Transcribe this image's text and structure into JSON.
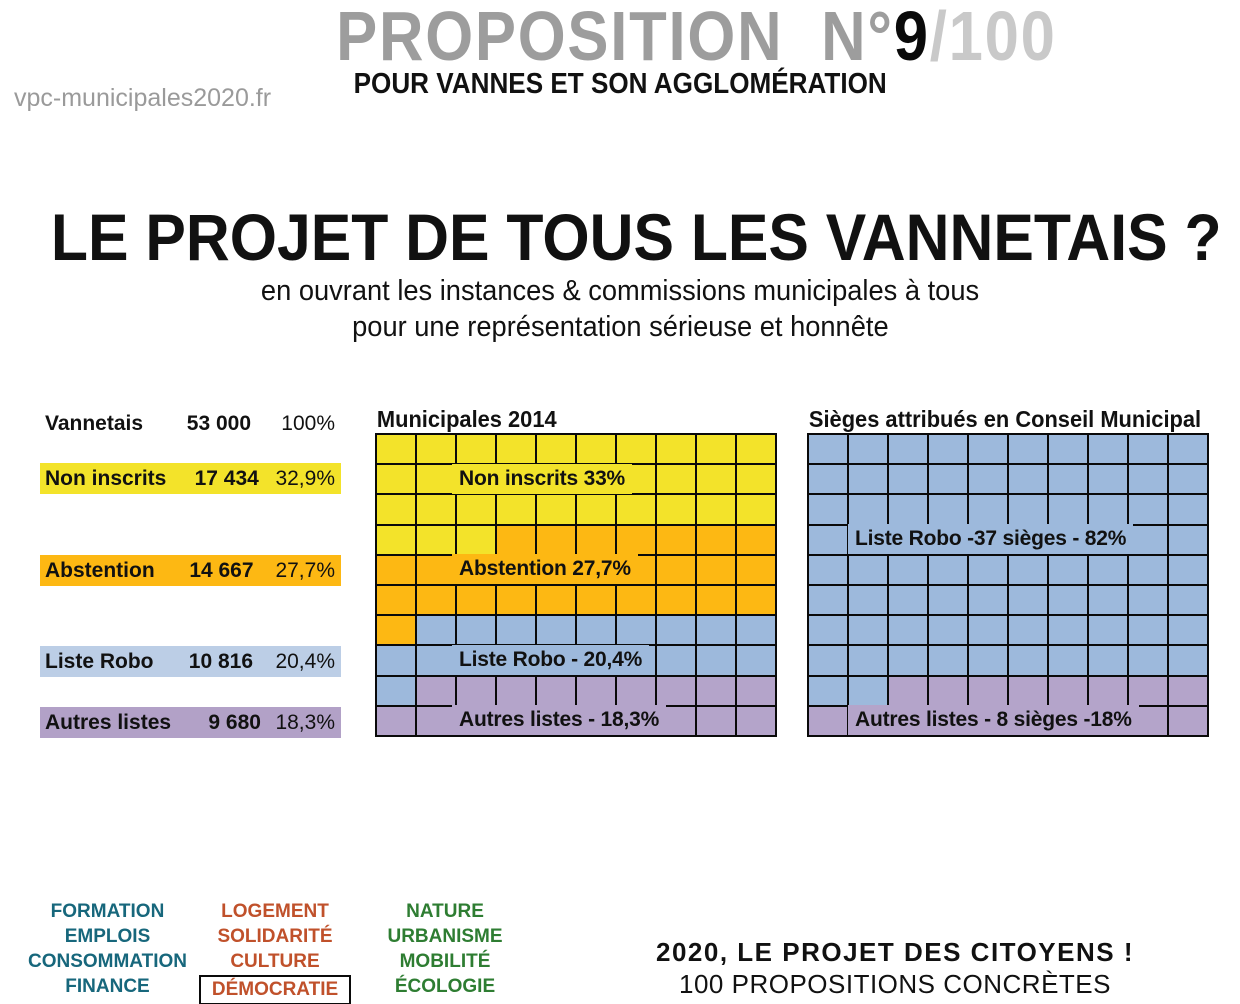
{
  "header": {
    "proposition_prefix": "PROPOSITION  N°",
    "proposition_number": "9",
    "proposition_total": "/100",
    "subtitle": "POUR VANNES ET SON AGGLOMÉRATION",
    "website": "vpc-municipales2020.fr"
  },
  "title": {
    "main": "LE PROJET DE TOUS LES VANNETAIS ?",
    "sub1": "en ouvrant les instances & commissions municipales à tous",
    "sub2": "pour une représentation sérieuse et honnête"
  },
  "stats_table": {
    "header_row": {
      "label": "Vannetais",
      "value": "53 000",
      "percent": "100%",
      "color": "transparent"
    },
    "rows": [
      {
        "label": "Non inscrits",
        "value": "17 434",
        "percent": "32,9%",
        "color": "#f3e32a"
      },
      {
        "label": "Abstention",
        "value": "14 667",
        "percent": "27,7%",
        "color": "#fdb813"
      },
      {
        "label": "Liste Robo",
        "value": "10 816",
        "percent": "20,4%",
        "color": "#bccee6"
      },
      {
        "label": "Autres listes",
        "value": "9 680",
        "percent": "18,3%",
        "color": "#b2a1c7"
      }
    ]
  },
  "chart_data": [
    {
      "type": "waffle",
      "title": "Municipales 2014",
      "grid": {
        "rows": 10,
        "cols": 10,
        "total_cells": 100
      },
      "series": [
        {
          "name": "Non inscrits",
          "cells": 33,
          "percent": "33%",
          "color": "#f3e32a"
        },
        {
          "name": "Abstention",
          "cells": 28,
          "percent": "27,7%",
          "color": "#fdb813"
        },
        {
          "name": "Liste Robo",
          "cells": 20,
          "percent": "20,4%",
          "color": "#9db9dc"
        },
        {
          "name": "Autres listes",
          "cells": 19,
          "percent": "18,3%",
          "color": "#b4a4ca"
        }
      ],
      "labels": [
        {
          "text": "Non inscrits 33%",
          "row": 2,
          "series": 0,
          "left": 76
        },
        {
          "text": "Abstention 27,7%",
          "row": 5,
          "series": 1,
          "left": 76
        },
        {
          "text": "Liste Robo - 20,4%",
          "row": 8,
          "series": 2,
          "left": 76
        },
        {
          "text": "Autres listes - 18,3%",
          "row": 10,
          "series": 3,
          "left": 76
        }
      ]
    },
    {
      "type": "waffle",
      "title": "Sièges attribués en Conseil Municipal",
      "grid": {
        "rows": 10,
        "cols": 10,
        "total_cells": 100
      },
      "series": [
        {
          "name": "Liste Robo",
          "cells": 82,
          "percent": "82%",
          "seats": "37",
          "color": "#9db9dc"
        },
        {
          "name": "Autres listes",
          "cells": 18,
          "percent": "18%",
          "seats": "8",
          "color": "#b4a4ca"
        }
      ],
      "labels": [
        {
          "text": "Liste Robo -37 sièges - 82%",
          "row": 4,
          "series": 0,
          "left": 40
        },
        {
          "text": "Autres listes - 8 sièges -18%",
          "row": 10,
          "series": 1,
          "left": 40
        }
      ]
    }
  ],
  "themes": {
    "columns": [
      {
        "color": "#17677c",
        "items": [
          "FORMATION",
          "EMPLOIS",
          "CONSOMMATION",
          "FINANCE"
        ]
      },
      {
        "color": "#c0512b",
        "items": [
          "LOGEMENT",
          "SOLIDARITÉ",
          "CULTURE",
          "DÉMOCRATIE"
        ],
        "boxed_item": "DÉMOCRATIE"
      },
      {
        "color": "#2e7d32",
        "items": [
          "NATURE",
          "URBANISME",
          "MOBILITÉ",
          "ÉCOLOGIE"
        ]
      }
    ]
  },
  "footer": {
    "line1": "2020, LE PROJET DES CITOYENS !",
    "line2": "100 PROPOSITIONS CONCRÈTES"
  }
}
